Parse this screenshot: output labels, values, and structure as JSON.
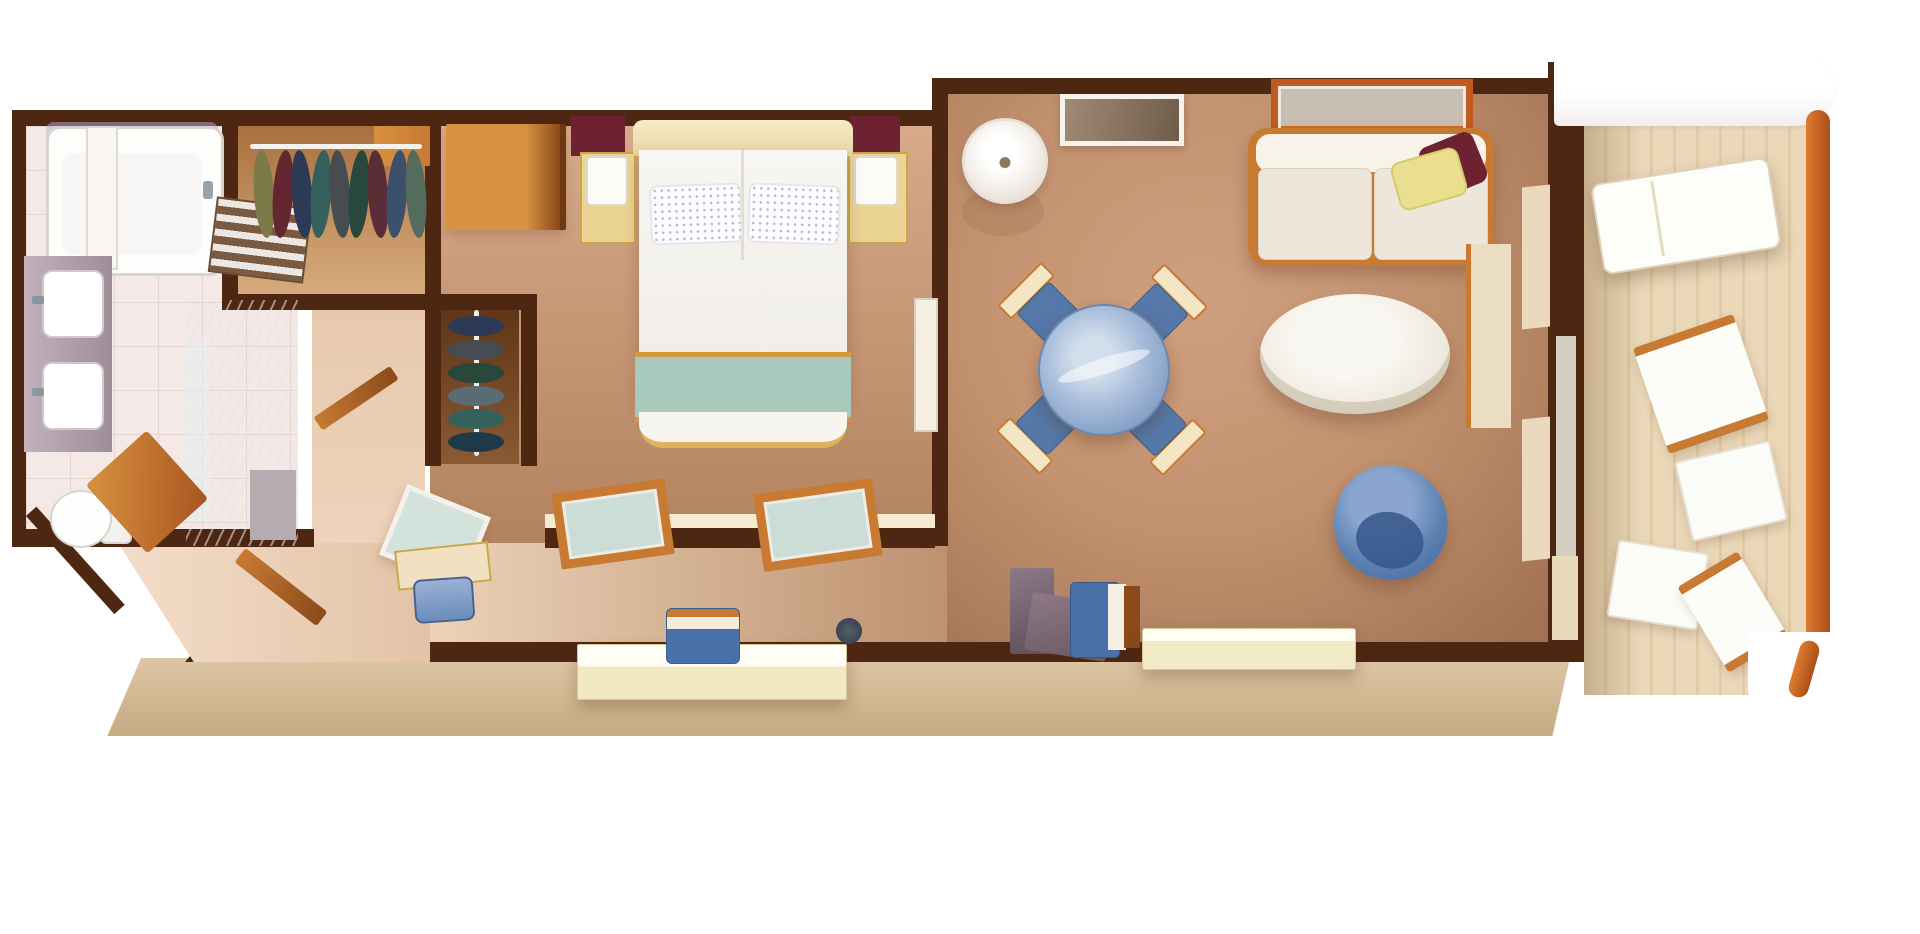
{
  "app": {
    "title": "Suite floor plan",
    "description": "Top-down 3D rendered floor plan of a ship suite with bathroom, walk-in closet, bedroom, living-dining room and private veranda",
    "background": "#ffffff"
  },
  "palette": {
    "bg": "#ffffff",
    "wall": "#4e2713",
    "wood": "#c87a33",
    "woodDark": "#8a4a1a",
    "woodLight": "#d8913f",
    "hull1": "#ddc6a4",
    "hull2": "#c6ab83",
    "teal": "#a9c9bd",
    "gold": "#d29a3a",
    "maroon": "#6e2130",
    "yellow": "#eadf8e",
    "blueSeat": "#5578a8",
    "blueDeep": "#4a70a8",
    "blueChair": "#5b80b0",
    "glassBlue": "#8fa9cc",
    "cream": "#f2e8c2",
    "creamLight": "#fffdf4",
    "railing": "#cd6a28",
    "lavender": "rgba(186,170,215,0.5)"
  },
  "scene": {
    "rooms": [
      {
        "id": "bathroom",
        "label": "Bathroom"
      },
      {
        "id": "walk-in-closet",
        "label": "Walk-in closet"
      },
      {
        "id": "second-closet",
        "label": "Second closet"
      },
      {
        "id": "bedroom",
        "label": "Bedroom"
      },
      {
        "id": "entry-hall",
        "label": "Entry hall"
      },
      {
        "id": "living-room",
        "label": "Living and dining room"
      },
      {
        "id": "balcony",
        "label": "Private veranda"
      }
    ],
    "labels": {
      "tub": "Bathtub with glass screen",
      "cabinet": "Bathroom cabinet",
      "vanity": "Double-sink vanity",
      "sink": "Sink",
      "shelf": "Towel shelf",
      "toilet": "Toilet",
      "shower": "Marble shower",
      "closetRail": "Clothes rail with hanging garments",
      "closetShelf": "Closet shelf",
      "bed": "Queen bed",
      "headboard": "Headboard",
      "pillow": "Pillow",
      "runner": "Teal bed runner",
      "nightstand": "Nightstand",
      "lamp": "Table lamp",
      "wardrobe": "Wardrobe cabinet",
      "accentPanel": "Accent panel",
      "window": "Window",
      "mirror": "Dressing mirror",
      "dressTable": "Dressing table",
      "stool": "Vanity stool",
      "entryDoor": "Entry door",
      "bench": "Entry side bench",
      "bathDoor": "Bathroom door",
      "console": "Console desk",
      "deskChair": "Desk chair",
      "bag": "Bag",
      "floorLamp": "Floor lamp",
      "wallArt": "Wall art",
      "sofa": "Sofa",
      "yellowPillow": "Yellow throw pillow",
      "maroonPillow": "Maroon throw pillow",
      "coffeeTable": "Round coffee table",
      "diningTable": "Round glass dining table",
      "diningChair": "Dining chair",
      "armchair": "Blue armchair",
      "marbleDesk": "Marble writing desk",
      "sideboard": "Sideboard",
      "tallCabinet": "Tall cabinet",
      "curtain": "Curtain panel",
      "balconyDoor": "Balcony glass door",
      "interiorDoor": "Interior door",
      "lounger": "Sun lounger",
      "deckChair": "Deck chair",
      "deckTable": "Deck table",
      "railing": "Veranda railing",
      "canopy": "Deck overhang",
      "hull": "Ship hull band"
    }
  }
}
